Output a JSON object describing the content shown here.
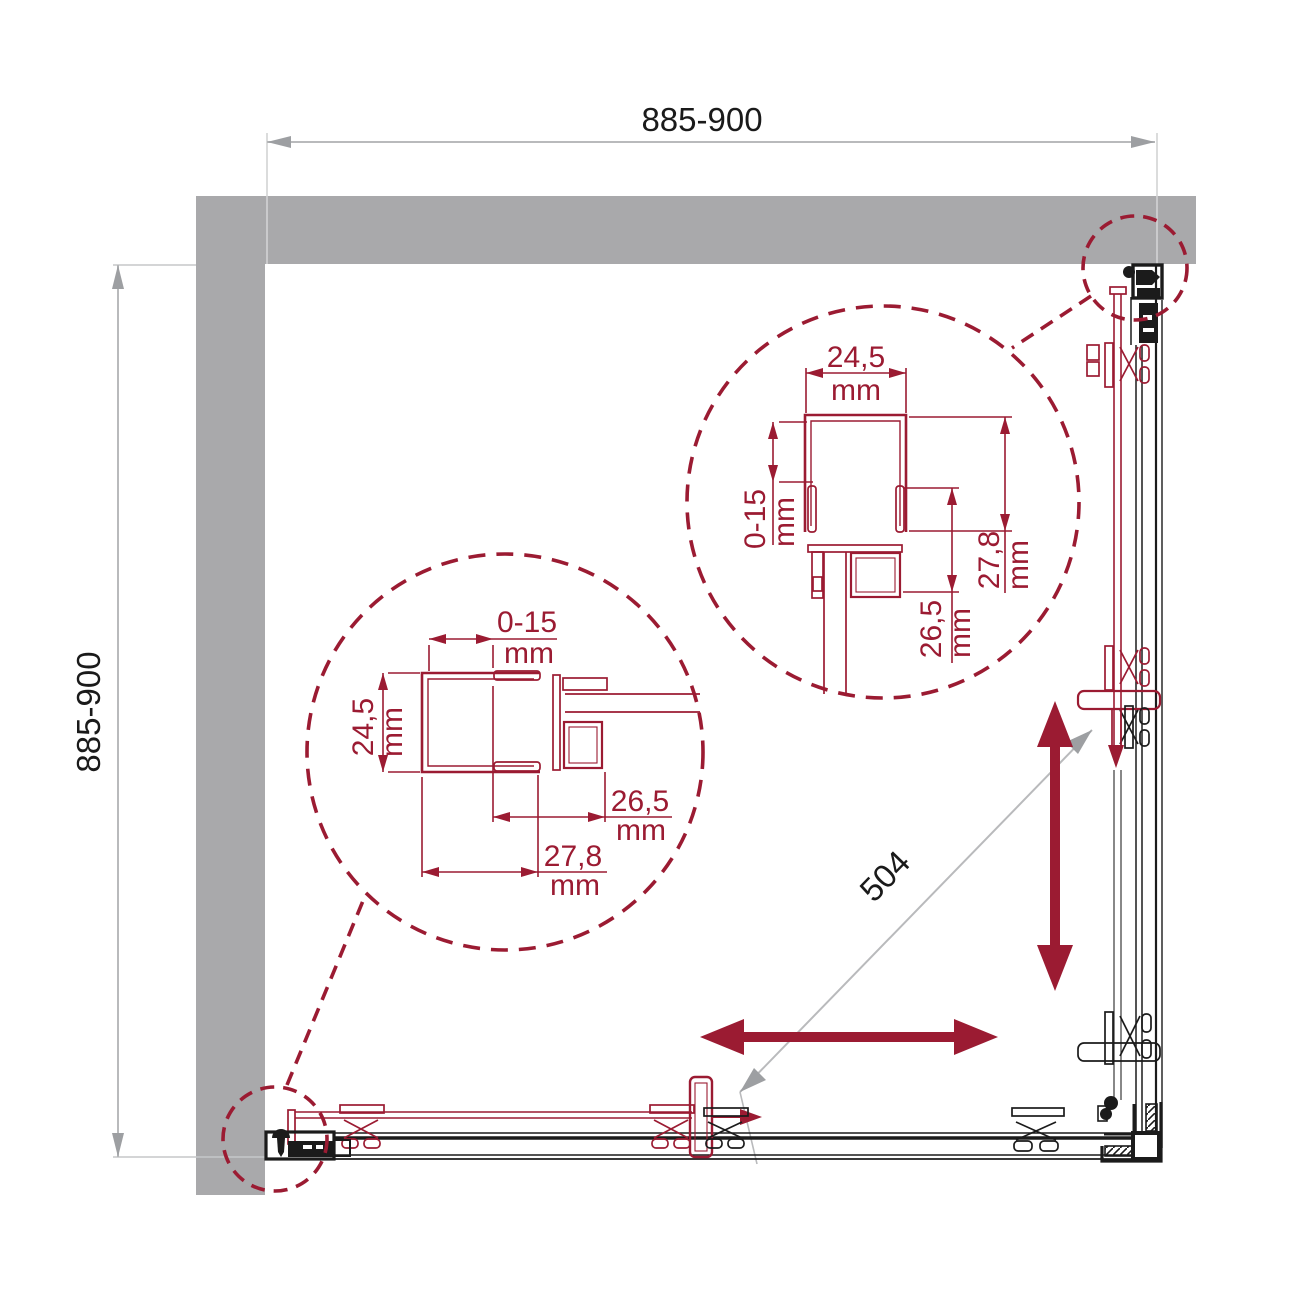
{
  "drawing": {
    "title": "corner shower enclosure plan view",
    "dim_width": "885-900",
    "dim_depth": "885-900",
    "dim_diagonal": "504",
    "detail_upper": {
      "profile_width": "24,5",
      "profile_width_unit": "mm",
      "adjustment": "0-15",
      "adjustment_unit": "mm",
      "depth_total": "27,8",
      "depth_total_unit": "mm",
      "depth_inner": "26,5",
      "depth_inner_unit": "mm"
    },
    "detail_lower": {
      "adjustment": "0-15",
      "adjustment_unit": "mm",
      "profile_width": "24,5",
      "profile_width_unit": "mm",
      "depth_inner": "26,5",
      "depth_inner_unit": "mm",
      "depth_total": "27,8",
      "depth_total_unit": "mm"
    },
    "colors": {
      "accent": "#9b1b32",
      "wall": "#a9a9ab",
      "dim_line": "#b9babc",
      "dim_arrow": "#9d9fa2",
      "ink": "#1b1b1b"
    }
  }
}
